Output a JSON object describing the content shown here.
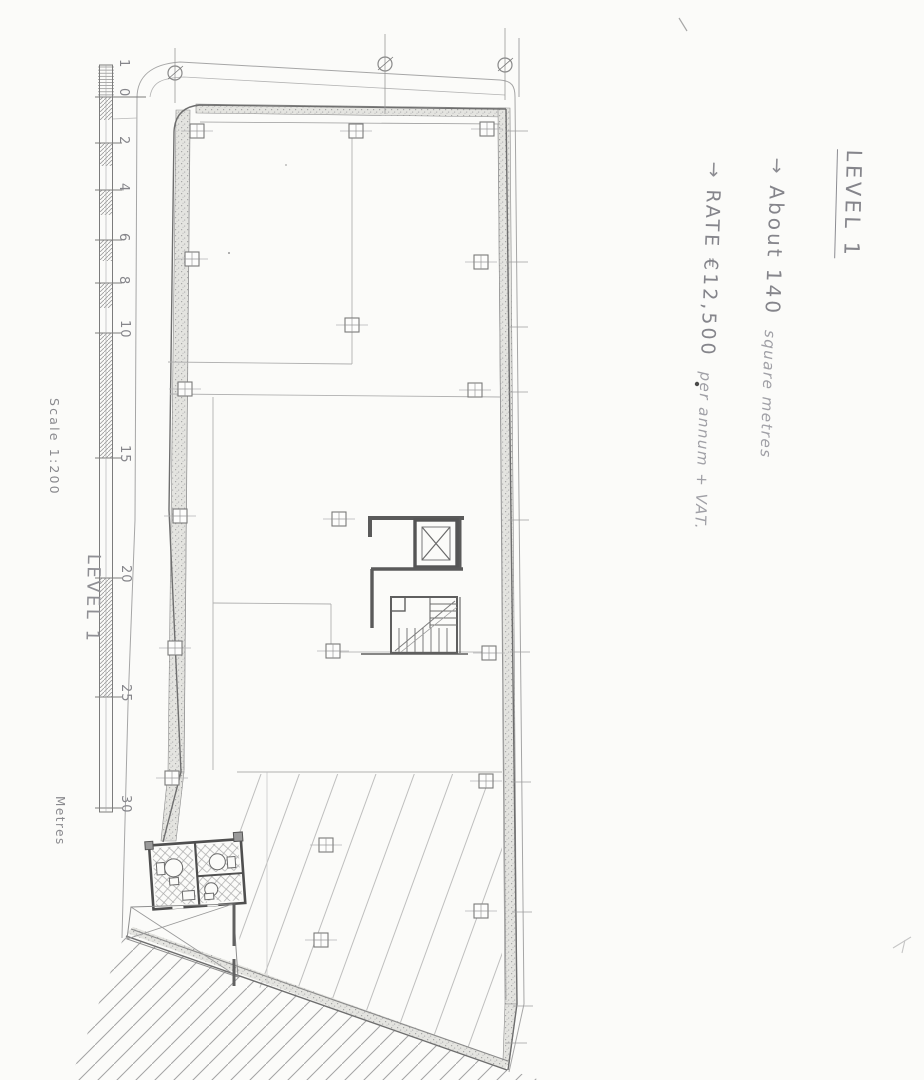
{
  "scale_bar": {
    "tick_labels": [
      "1",
      "0",
      "2",
      "4",
      "6",
      "8",
      "10",
      "15",
      "20",
      "25",
      "30"
    ],
    "scale_text": "Scale 1:200",
    "units_label": "Metres",
    "level_label": "LEVEL 1"
  },
  "notes": {
    "title": "LEVEL 1",
    "area": {
      "arrow": "→",
      "lead": "About 140",
      "tail": "square metres"
    },
    "rate": {
      "arrow": "→",
      "lead": "RATE €12,500",
      "tail": "per annum + VAT."
    }
  },
  "colors": {
    "paper": "#fbfbf9",
    "pencil_dark": "#6b6b6b",
    "pencil": "#8e8e93",
    "pencil_light": "#b3b3b3"
  }
}
